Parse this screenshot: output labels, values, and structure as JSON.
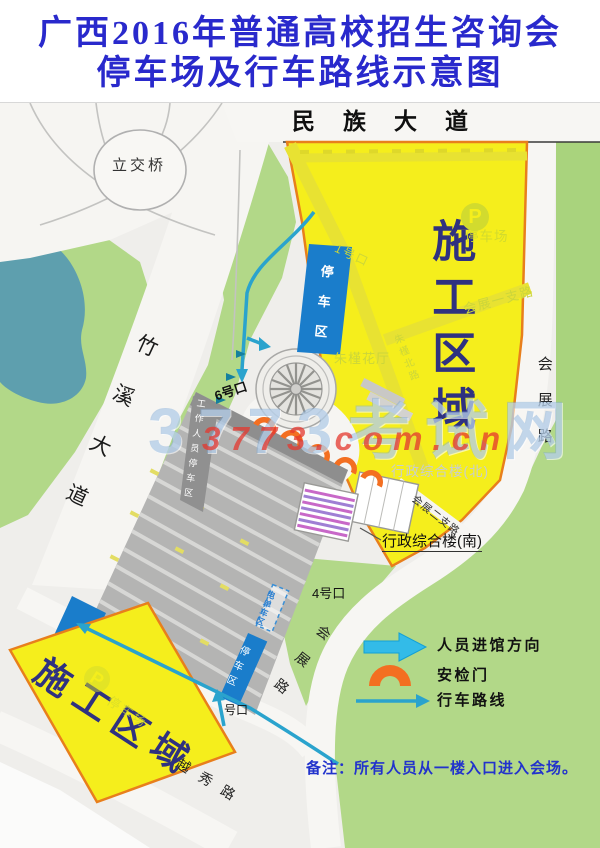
{
  "title": {
    "line1": "广西2016年普通高校招生咨询会",
    "line2": "停车场及行车路线示意图"
  },
  "roads": {
    "minzu_dadao": "民族大道",
    "zhuxi_dadao": "竹溪大道",
    "huizhan_lu_east": "会展路",
    "huizhan_lu_south": "会展路",
    "yuexiu_lu": "越秀路",
    "huizhan_yizhilu": "会展一支路",
    "huizhan_erzhilu": "会展二支路",
    "zhujin_beilu": "朱槿北路"
  },
  "areas": {
    "construction_north": "施工区域",
    "construction_south": "施工区域",
    "overpass": "立交桥",
    "parking_zone_top": "停车区",
    "parking_zone_bottom": "停车区",
    "ebike_zone": "电单车区",
    "staff_parking": "工作人员停车区",
    "parking_lot_north": "停车场",
    "parking_lot_south": "停车场",
    "p_symbol": "P"
  },
  "buildings": {
    "zhujin_hall": "朱槿花厅",
    "admin_north": "行政综合楼(北)",
    "admin_south": "行政综合楼(南)"
  },
  "gates": {
    "gate_1": "1号口",
    "gate_4": "4号口",
    "gate_6": "6号口",
    "gate_south": "号口"
  },
  "legend": {
    "entry_direction": "人员进馆方向",
    "security_gate": "安检门",
    "driving_route": "行车路线"
  },
  "note": "备注：所有人员从一楼入口进入会场。",
  "watermark": {
    "line1": "3773考试网",
    "line2": "3773.com.cn"
  },
  "colors": {
    "title_blue": "#2929cc",
    "construction_yellow": "#f5ee1c",
    "construction_border_orange": "#e87f1c",
    "area_text_navy": "#2f3180",
    "green": "#b2d888",
    "water_teal": "#5e9fae",
    "road_white": "#f7f6f3",
    "parking_gray": "#b5b5b4",
    "blue_parking": "#1a7dcb",
    "route_teal": "#2aa3cd",
    "security_orange": "#f36f21",
    "note_blue": "#2233cc"
  }
}
